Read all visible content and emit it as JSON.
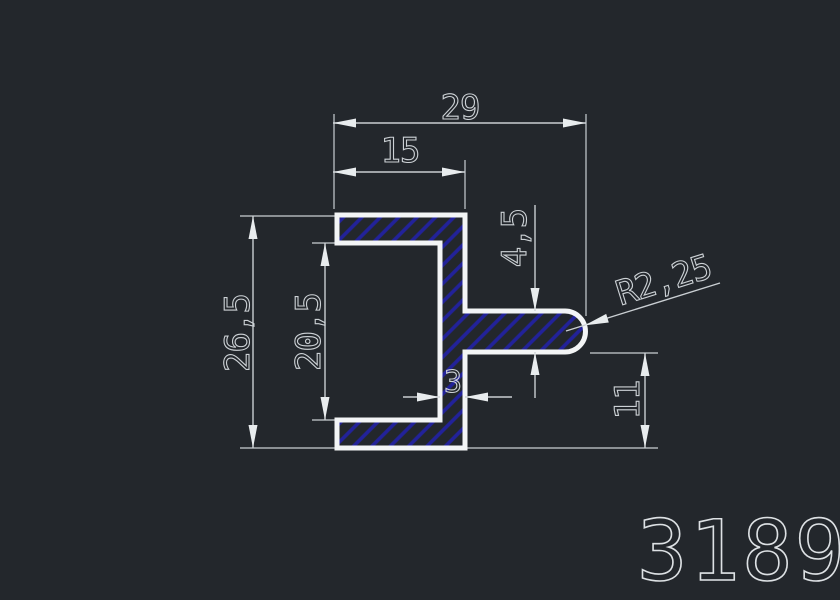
{
  "drawing": {
    "type": "cad-profile-cross-section",
    "part_number": "3189",
    "dims": {
      "overall_width": {
        "label": "29"
      },
      "flange_width": {
        "label": "15"
      },
      "overall_height": {
        "label": "26,5"
      },
      "inner_height": {
        "label": "20,5"
      },
      "tab_thickness": {
        "label": "4,5"
      },
      "wall_thickness": {
        "label": "3"
      },
      "tab_to_bottom": {
        "label": "11"
      },
      "tip_radius": {
        "label": "R2,25"
      }
    },
    "colors": {
      "background": "#23272c",
      "profile_outline": "#f3f5f6",
      "hatch_lines": "#22229a",
      "dimension_lines": "#c9ced2",
      "dimension_text": "#ccd1d5",
      "part_number_text": "#dde1e4"
    }
  }
}
